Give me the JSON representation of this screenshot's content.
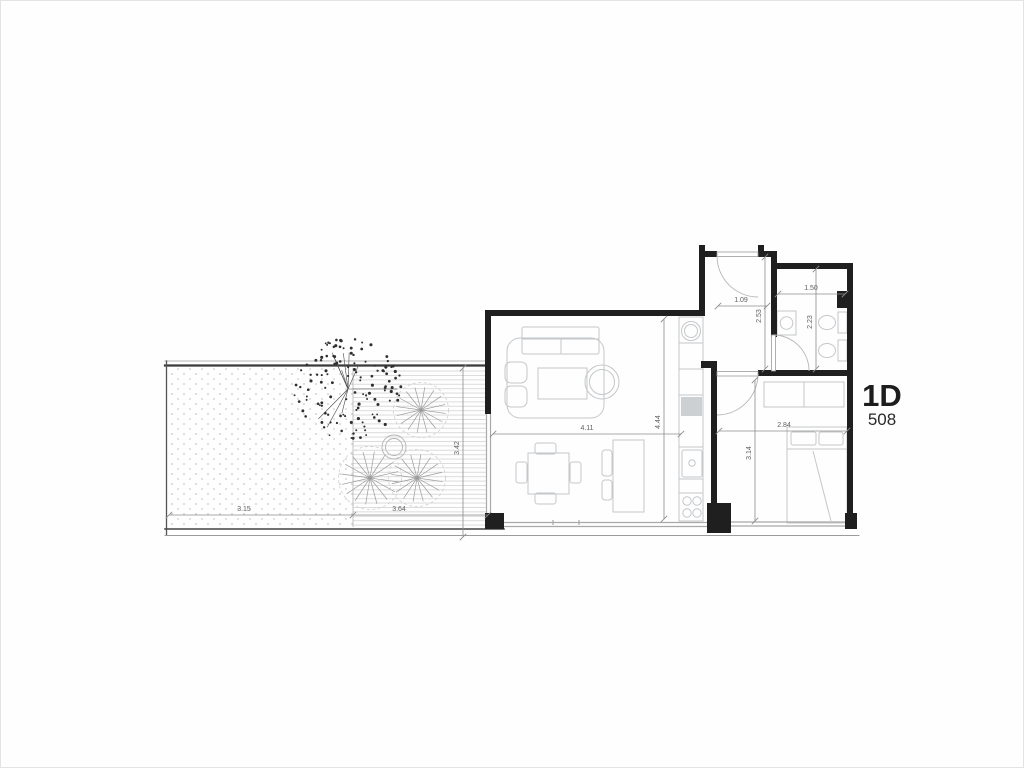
{
  "unit": {
    "name": "1D",
    "number": "508"
  },
  "dimensions": {
    "terrace_width": "3.15",
    "deck_width": "3.64",
    "deck_depth": "3.42",
    "living_width": "4.11",
    "living_depth": "4.44",
    "hall_width": "1.09",
    "hall_depth": "2.53",
    "bathroom_width": "1.50",
    "bathroom_depth": "2.23",
    "bedroom_width": "2.84",
    "bedroom_depth": "3.14"
  },
  "colors": {
    "background": "#ffffff",
    "wall": "#1f1f1f",
    "furniture_line": "#c4c7c9",
    "glazing": "#a9a9a9",
    "dimension_line": "#8d8d8d",
    "dimension_text": "#5f5f5f",
    "deck_stripe": "#d8d8d8",
    "terrace_dot": "#c6c6c6",
    "tree": "#2f2f2f",
    "plant": "#9b9b9b",
    "unit_text": "#1d1d1d"
  }
}
